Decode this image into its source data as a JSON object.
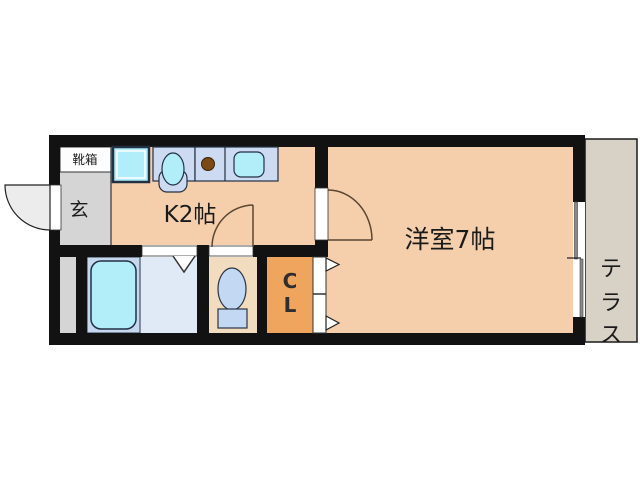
{
  "plan": {
    "shoe_box_label": "靴箱",
    "entrance_label": "玄",
    "kitchen_label": "K2帖",
    "western_room_label": "洋室7帖",
    "closet_letters": [
      "C",
      "L"
    ],
    "terrace_letters": [
      "テ",
      "ラ",
      "ス"
    ]
  },
  "colors": {
    "wall_black": "#121212",
    "floor_peach": "#f5cfab",
    "toilet_floor": "#f2dcc0",
    "closet_orange": "#efa55d",
    "entrance_gray": "#d5d5d5",
    "terrace_gray": "#d7d1c6",
    "washroom_blue": "#dfeaf6",
    "tub_panel_blue": "#c6d8ee",
    "fixture_cyan": "#b2edfa",
    "counter_blue": "#ccdaf2",
    "burner_brown": "#7b4a14",
    "door_arc_brown": "#5a4632"
  }
}
